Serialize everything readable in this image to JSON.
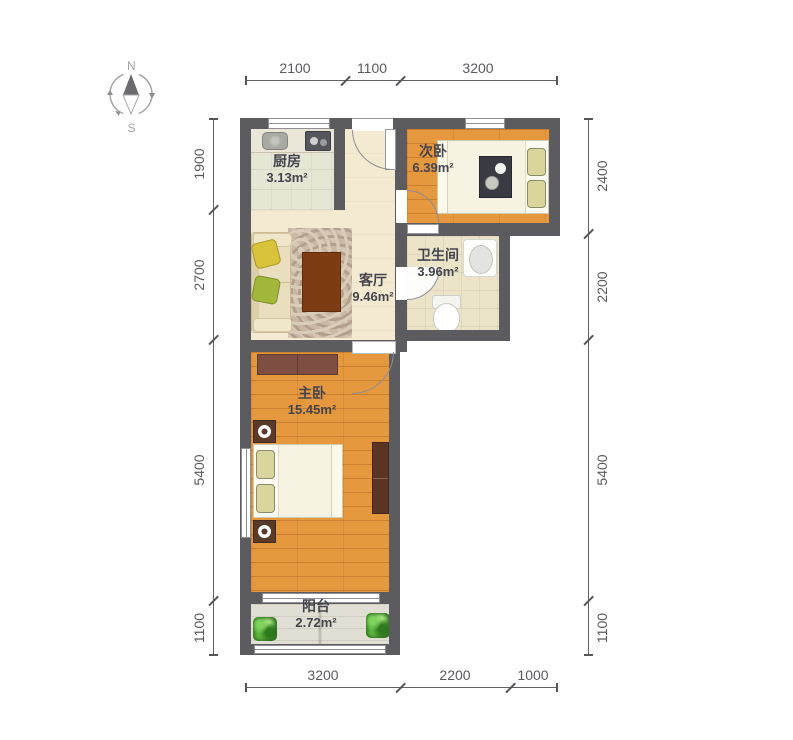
{
  "compass": {
    "north": "N",
    "south": "S"
  },
  "rooms": {
    "kitchen": {
      "name": "厨房",
      "area": "3.13m²"
    },
    "second_bedroom": {
      "name": "次卧",
      "area": "6.39m²"
    },
    "living_room": {
      "name": "客厅",
      "area": "9.46m²"
    },
    "bathroom": {
      "name": "卫生间",
      "area": "3.96m²"
    },
    "master_bedroom": {
      "name": "主卧",
      "area": "15.45m²"
    },
    "balcony": {
      "name": "阳台",
      "area": "2.72m²"
    }
  },
  "dimensions": {
    "top": [
      "2100",
      "1100",
      "3200"
    ],
    "bottom": [
      "3200",
      "2200",
      "1000"
    ],
    "left": [
      "1900",
      "2700",
      "5400",
      "1100"
    ],
    "right": [
      "2400",
      "2200",
      "5400",
      "1100"
    ]
  },
  "colors": {
    "wall": "#5b5b60",
    "wood_floor": "#e6983f",
    "living_floor": "#f4ead2",
    "kitchen_floor": "#e6e6d4",
    "bathroom_floor": "#ece4c9",
    "balcony_floor": "#e1dfd3",
    "dimension_text": "#5a5a5e",
    "room_label_text": "#44444e",
    "plant_green": "#4e9b35",
    "furniture_brown": "#7d4e41",
    "table_brown": "#7e3c14"
  }
}
